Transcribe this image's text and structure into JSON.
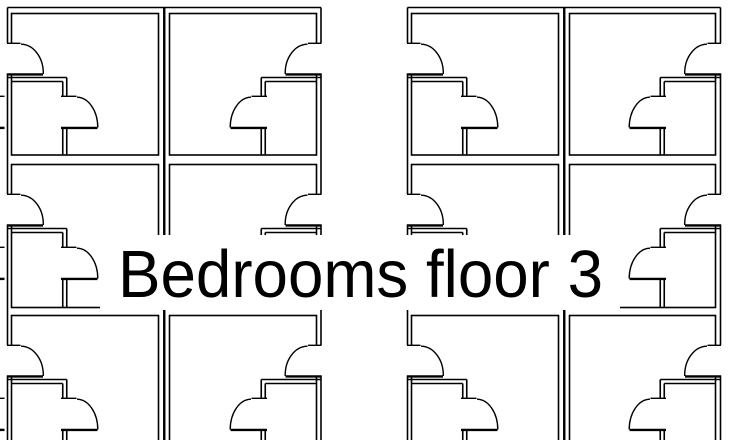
{
  "title": "Bedrooms floor 3",
  "colors": {
    "background": "#ffffff",
    "line": "#000000",
    "text": "#000000",
    "label_background": "#ffffff"
  },
  "canvas": {
    "width": 732,
    "height": 440
  },
  "label": {
    "band_x": 100,
    "band_y": 235,
    "band_width": 520,
    "band_height": 75,
    "text_x": 118,
    "baseline_y": 297,
    "font_size": 67,
    "text_length": 485
  },
  "floorplan": {
    "outer_top": 7.5,
    "blocks": [
      {
        "name": "west-wing",
        "outer_left": 7.5,
        "outer_right": 321,
        "party_x": 164.25,
        "columns": [
          {
            "name": "room-column-a",
            "inner_left": 11.5,
            "inner_right": 158.5,
            "facing": "left"
          },
          {
            "name": "room-column-b",
            "inner_left": 169.5,
            "inner_right": 316.5,
            "facing": "right"
          }
        ]
      },
      {
        "name": "east-wing",
        "outer_left": 407.5,
        "outer_right": 720.5,
        "party_x": 564.25,
        "columns": [
          {
            "name": "room-column-c",
            "inner_left": 411.5,
            "inner_right": 558.5,
            "facing": "left"
          },
          {
            "name": "room-column-d",
            "inner_left": 569.5,
            "inner_right": 715.5,
            "facing": "right"
          }
        ]
      }
    ],
    "rows": [
      {
        "top": 13.5,
        "bottom": 155
      },
      {
        "top": 164.5,
        "bottom": 307.5
      },
      {
        "top": 315.5,
        "bottom": 458
      }
    ],
    "entry_door": {
      "opening_top": 29.5,
      "opening_bottom": 60,
      "tick_len": 13,
      "leaf_len": 35.5,
      "arc_rx": 22.5,
      "arc_ry": 29
    },
    "closet": {
      "width": 55.25,
      "inner_width": 51.25,
      "top": 64,
      "inner_top": 68,
      "opening_top": 82.5,
      "opening_bottom": 113.5,
      "tick_from": 50,
      "tick_len": 15,
      "leaf_from": 50.5,
      "leaf_len": 35.5,
      "arc_rx": 21,
      "arc_ry": 30.5
    },
    "edge_stubs": {
      "x": 0,
      "len": 4.5
    },
    "stroke": {
      "wall": 1.6,
      "party": 2.4,
      "tick": 1.4,
      "leaf": 2.4,
      "arc": 1.4
    }
  }
}
